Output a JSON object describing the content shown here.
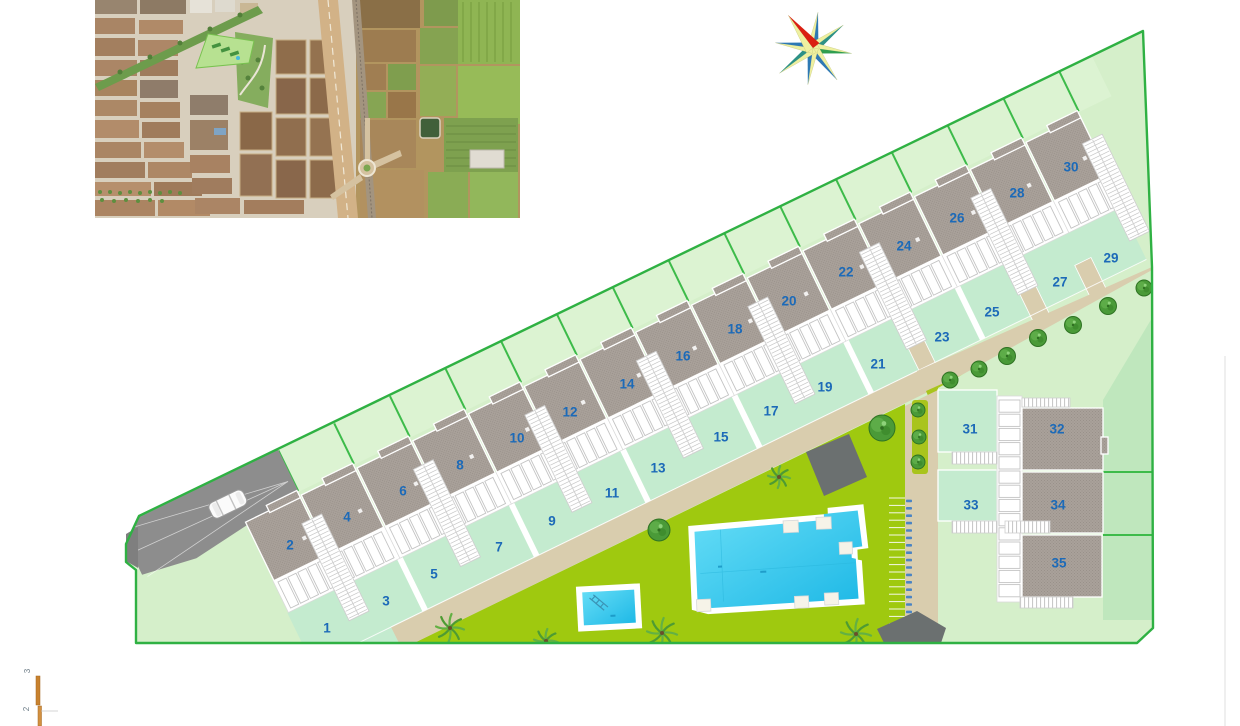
{
  "page": {
    "background": "#ffffff",
    "title": "residential development site plan"
  },
  "plan": {
    "colors": {
      "boundary": "#2fb143",
      "divider": "#3dbb4a",
      "base_green": "#d5efca",
      "back_garden": "#dcf3d2",
      "garden_mint": "#c4ebcf",
      "cluster_green": "#bfe7bd",
      "communal": "#9fc90f",
      "hedge": "#a9c41d",
      "path": "#d9cdae",
      "roof": "#a9a19a",
      "driveway": "#8d8d8d",
      "pool_water": "#35c9ea",
      "label_blue": "#1c6ab8",
      "pergola": "#6b7070",
      "scale_orange": "#c8822f"
    },
    "plots": [
      {
        "n": "1",
        "x": 327,
        "y": 628,
        "kind": "garden"
      },
      {
        "n": "2",
        "x": 290,
        "y": 545,
        "kind": "roof"
      },
      {
        "n": "3",
        "x": 386,
        "y": 601,
        "kind": "garden"
      },
      {
        "n": "4",
        "x": 347,
        "y": 517,
        "kind": "roof"
      },
      {
        "n": "5",
        "x": 434,
        "y": 574,
        "kind": "garden"
      },
      {
        "n": "6",
        "x": 403,
        "y": 491,
        "kind": "roof"
      },
      {
        "n": "7",
        "x": 499,
        "y": 547,
        "kind": "garden"
      },
      {
        "n": "8",
        "x": 460,
        "y": 465,
        "kind": "roof"
      },
      {
        "n": "9",
        "x": 552,
        "y": 521,
        "kind": "garden"
      },
      {
        "n": "10",
        "x": 517,
        "y": 438,
        "kind": "roof"
      },
      {
        "n": "11",
        "x": 612,
        "y": 493,
        "kind": "garden"
      },
      {
        "n": "12",
        "x": 570,
        "y": 412,
        "kind": "roof"
      },
      {
        "n": "13",
        "x": 658,
        "y": 468,
        "kind": "garden"
      },
      {
        "n": "14",
        "x": 627,
        "y": 384,
        "kind": "roof"
      },
      {
        "n": "15",
        "x": 721,
        "y": 437,
        "kind": "garden"
      },
      {
        "n": "16",
        "x": 683,
        "y": 356,
        "kind": "roof"
      },
      {
        "n": "17",
        "x": 771,
        "y": 411,
        "kind": "garden"
      },
      {
        "n": "18",
        "x": 735,
        "y": 329,
        "kind": "roof"
      },
      {
        "n": "19",
        "x": 825,
        "y": 387,
        "kind": "garden"
      },
      {
        "n": "20",
        "x": 789,
        "y": 301,
        "kind": "roof"
      },
      {
        "n": "21",
        "x": 878,
        "y": 364,
        "kind": "garden"
      },
      {
        "n": "22",
        "x": 846,
        "y": 272,
        "kind": "roof"
      },
      {
        "n": "23",
        "x": 942,
        "y": 337,
        "kind": "garden"
      },
      {
        "n": "24",
        "x": 904,
        "y": 246,
        "kind": "roof"
      },
      {
        "n": "25",
        "x": 992,
        "y": 312,
        "kind": "garden"
      },
      {
        "n": "26",
        "x": 957,
        "y": 218,
        "kind": "roof"
      },
      {
        "n": "27",
        "x": 1060,
        "y": 282,
        "kind": "garden"
      },
      {
        "n": "28",
        "x": 1017,
        "y": 193,
        "kind": "roof"
      },
      {
        "n": "29",
        "x": 1111,
        "y": 258,
        "kind": "garden"
      },
      {
        "n": "30",
        "x": 1071,
        "y": 167,
        "kind": "roof"
      },
      {
        "n": "31",
        "x": 970,
        "y": 429,
        "kind": "garden"
      },
      {
        "n": "32",
        "x": 1057,
        "y": 429,
        "kind": "roof"
      },
      {
        "n": "33",
        "x": 971,
        "y": 505,
        "kind": "garden"
      },
      {
        "n": "34",
        "x": 1058,
        "y": 505,
        "kind": "roof"
      },
      {
        "n": "35",
        "x": 1059,
        "y": 563,
        "kind": "roof"
      }
    ],
    "scale_marks": [
      {
        "label": "3",
        "x": 30,
        "y": 671
      },
      {
        "label": "2",
        "x": 29,
        "y": 709
      }
    ],
    "row": {
      "origin_x": 290,
      "origin_y": 545,
      "angle": -25.95,
      "module_count": 15,
      "module_pitch": 62,
      "stairs_x": [
        31,
        155,
        279,
        403,
        527,
        651,
        775,
        899
      ],
      "white_dividers_x": [
        93,
        217,
        341,
        465,
        589,
        713
      ],
      "path_stubs_x": [
        651,
        775,
        837
      ],
      "terrace_boxes_per_module": 5
    },
    "cluster": {
      "terrace_boxes": 14
    },
    "trees_round": [
      {
        "x": 950,
        "y": 380,
        "r": 8
      },
      {
        "x": 979,
        "y": 369,
        "r": 8
      },
      {
        "x": 1007,
        "y": 356,
        "r": 8.5
      },
      {
        "x": 1038,
        "y": 338,
        "r": 8.5
      },
      {
        "x": 1073,
        "y": 325,
        "r": 8.5
      },
      {
        "x": 1108,
        "y": 306,
        "r": 8.5
      },
      {
        "x": 1144,
        "y": 288,
        "r": 8
      },
      {
        "x": 918,
        "y": 410,
        "r": 7
      },
      {
        "x": 919,
        "y": 437,
        "r": 7
      },
      {
        "x": 918,
        "y": 462,
        "r": 7
      },
      {
        "x": 882,
        "y": 428,
        "r": 13
      },
      {
        "x": 659,
        "y": 530,
        "r": 11
      }
    ],
    "palms": [
      {
        "x": 450,
        "y": 628,
        "s": 14
      },
      {
        "x": 546,
        "y": 641,
        "s": 12
      },
      {
        "x": 662,
        "y": 633,
        "s": 15
      },
      {
        "x": 856,
        "y": 634,
        "s": 15
      },
      {
        "x": 779,
        "y": 477,
        "s": 11
      }
    ],
    "bike_stalls": {
      "count": 20,
      "x": 889,
      "y_start": 498,
      "step": 7.4
    },
    "compass": {
      "cx": 813,
      "cy": 48,
      "rotation": 8,
      "light": "#eef0a0",
      "points": [
        {
          "len": 36,
          "color": "#2e79b4"
        },
        {
          "len": 38,
          "color": "#2d9186"
        },
        {
          "len": 39,
          "color": "#2f9e4f"
        },
        {
          "len": 40,
          "color": "#2e79b4"
        },
        {
          "len": 37,
          "color": "#2e79b4"
        },
        {
          "len": 42,
          "color": "#2d9186"
        },
        {
          "len": 38,
          "color": "#2e79b4"
        },
        {
          "len": 41,
          "color": "#da1f12",
          "red": true
        }
      ]
    }
  }
}
